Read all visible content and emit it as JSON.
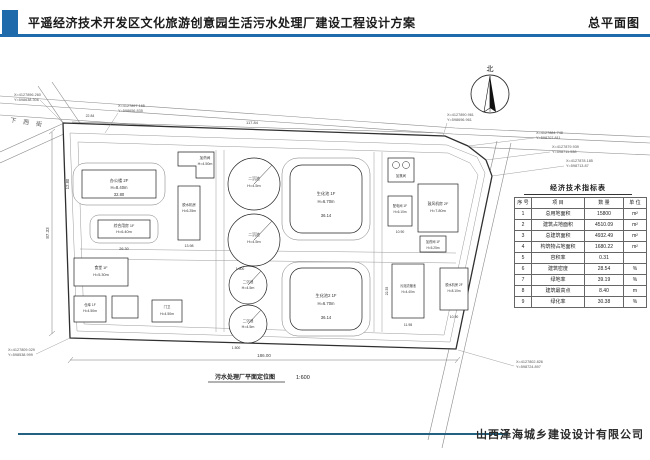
{
  "colors": {
    "accent_blue": "#1f6aab",
    "footer_line": "#24607f",
    "drawing_line": "#333333",
    "dim_gray": "#666666"
  },
  "header": {
    "title": "平遥经济技术开发区文化旅游创意园生活污水处理厂建设工程设计方案",
    "sheet_label": "总平面图"
  },
  "footer": {
    "company": "山西泽海城乡建设设计有限公司"
  },
  "compass": {
    "label": "北"
  },
  "roads": {
    "street_name": "下西街"
  },
  "caption": {
    "text": "污水处理厂平面定位图",
    "scale": "1:600"
  },
  "dims": {
    "site_width": "186.00",
    "site_height": "87.33",
    "top_width": "117.84",
    "top_offset": "22.84",
    "office_w": "32.80",
    "office_d": "12.80",
    "dorm_w": "26.30",
    "biopool_w": "36.14",
    "biopool2_w": "36.14",
    "dewater1_w": "13.98",
    "sludge_w": "11.98",
    "sludge_d": "22.35",
    "power_w": "10.90",
    "dewater2_w": "10.90",
    "radius1": "1.500",
    "radius2": "1.500"
  },
  "buildings": {
    "office": {
      "name": "办公楼 2F",
      "height": "H=8.40m"
    },
    "dorm": {
      "name": "综合用房 1F",
      "height": "H=6.40m"
    },
    "dosing1": {
      "name": "加药间",
      "height": "H=4.50m"
    },
    "dewater1": {
      "name": "脱水机房",
      "height": "H=6.25m"
    },
    "clarifier1": {
      "name": "二沉池",
      "height": "H=4.5m"
    },
    "clarifier2": {
      "name": "二沉池",
      "height": "H=4.5m"
    },
    "clarifier3": {
      "name": "二沉池",
      "height": "H=4.5m"
    },
    "clarifier4": {
      "name": "二沉池",
      "height": "H=4.5m"
    },
    "biopool1": {
      "name": "生化池 1F",
      "height": "H=6.70m"
    },
    "biopool2": {
      "name": "生化池2 1F",
      "height": "H=6.70m"
    },
    "chlorine": {
      "name": "加氯间",
      "height": "H=4.5m"
    },
    "blower": {
      "name": "鼓风机房 2F",
      "height": "H=7.80m"
    },
    "power": {
      "name": "配电间 1F",
      "height": "H=6.10m"
    },
    "dosing2": {
      "name": "加药间 1F",
      "height": "H=5.25m"
    },
    "sludge": {
      "name": "污泥浓缩池",
      "height": "H=4.40m"
    },
    "dewater2": {
      "name": "脱水机房 2F",
      "height": "H=8.10m"
    },
    "canteen": {
      "name": "食堂 1F",
      "height": "H=5.30m"
    },
    "warehouse": {
      "name": "仓库 1F",
      "height": "H=4.50m"
    },
    "gate": {
      "name": "门卫",
      "height": "H=4.50m"
    }
  },
  "coords": {
    "tl1": {
      "x": "X=4127896.260",
      "y": "Y=598638.306"
    },
    "tl2": {
      "x": "X=4127897.165",
      "y": "Y=598656.835"
    },
    "tr1": {
      "x": "X=4127890.961",
      "y": "Y=598696.961"
    },
    "tr2": {
      "x": "X=4127884.748",
      "y": "Y=598707.811"
    },
    "tr3": {
      "x": "X=4127879.939",
      "y": "Y=598711.538"
    },
    "tr4": {
      "x": "X=4127878.185",
      "y": "Y=598713.87"
    },
    "bl": {
      "x": "X=4127809.029",
      "y": "Y=598538.999"
    },
    "br": {
      "x": "X=4127802.826",
      "y": "Y=598724.897"
    }
  },
  "table": {
    "title": "经济技术指标表",
    "headers": [
      "序 号",
      "项 目",
      "数 量",
      "单 位"
    ],
    "rows": [
      {
        "no": "1",
        "item": "总用地面积",
        "qty": "15800",
        "unit": "m²"
      },
      {
        "no": "2",
        "item": "建筑占地面积",
        "qty": "4510.09",
        "unit": "m²"
      },
      {
        "no": "3",
        "item": "总建筑面积",
        "qty": "4932.49",
        "unit": "m²"
      },
      {
        "no": "4",
        "item": "构筑物占地面积",
        "qty": "1680.22",
        "unit": "m²"
      },
      {
        "no": "5",
        "item": "容积率",
        "qty": "0.31",
        "unit": ""
      },
      {
        "no": "6",
        "item": "建筑密度",
        "qty": "28.54",
        "unit": "%"
      },
      {
        "no": "7",
        "item": "绿地率",
        "qty": "39.19",
        "unit": "%"
      },
      {
        "no": "8",
        "item": "建筑最高点",
        "qty": "8.40",
        "unit": "m"
      },
      {
        "no": "9",
        "item": "绿化率",
        "qty": "30.38",
        "unit": "%"
      }
    ]
  }
}
